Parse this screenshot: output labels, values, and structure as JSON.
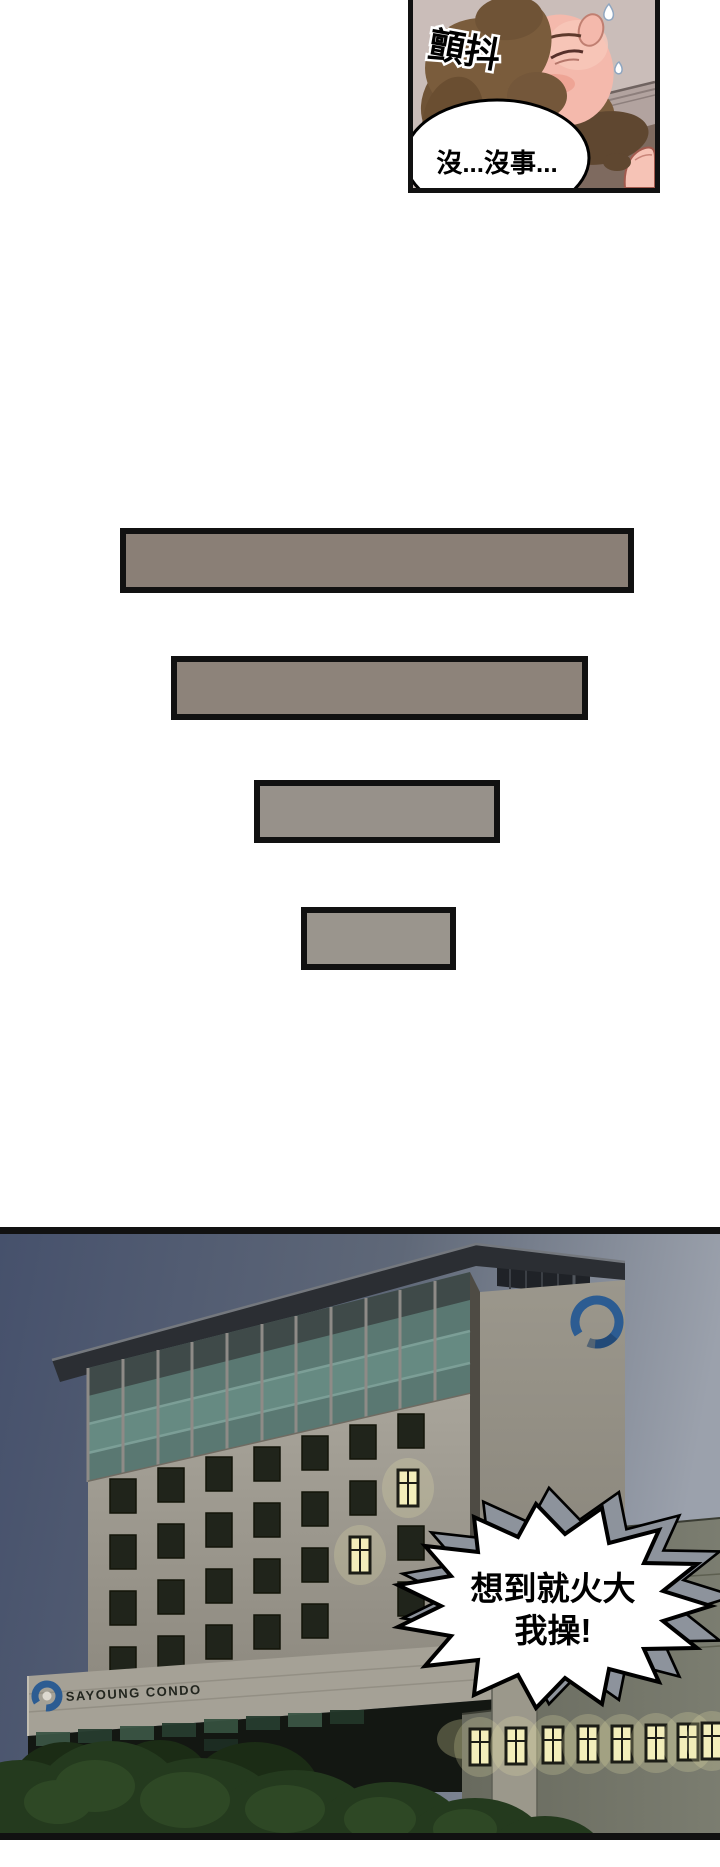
{
  "page": {
    "background": "#ffffff"
  },
  "top_panel": {
    "sfx": "顫抖",
    "bubble_text": "沒...沒事...",
    "colors": {
      "wall": "#cabdb9",
      "hair": "#7a5c3c",
      "skin": "#f4b9ac"
    }
  },
  "transition_bars": [
    {
      "color": "#8a7f76"
    },
    {
      "color": "#8d837a"
    },
    {
      "color": "#97918a"
    },
    {
      "color": "#9a958d"
    }
  ],
  "bottom_panel": {
    "sign_text": "SAYOUNG CONDO",
    "bubble_lines": [
      "想到就火大",
      "我操!"
    ],
    "colors": {
      "sky_left": "#46516c",
      "sky_mid": "#5f6878",
      "sky_right": "#9ba1ac",
      "logo_blue": "#2c5c92",
      "lit_window": "#f3eebb",
      "tree": "#243a1e"
    }
  }
}
